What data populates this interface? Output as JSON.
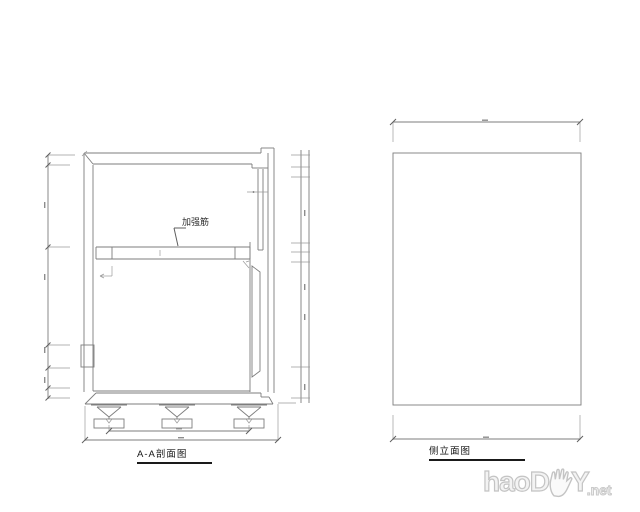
{
  "views": {
    "section": {
      "title": "A-A剖面图",
      "annotation_label": "加强筋"
    },
    "elevation": {
      "title": "侧立面图"
    }
  },
  "watermark": {
    "text_main": "haoD",
    "text_tail": "Y",
    "text_suffix": ".net",
    "icon": "hand-icon",
    "color": "#c4c4c4"
  },
  "colors": {
    "background": "#ffffff",
    "line": "#7d7d7d",
    "label_text": "#141414"
  }
}
